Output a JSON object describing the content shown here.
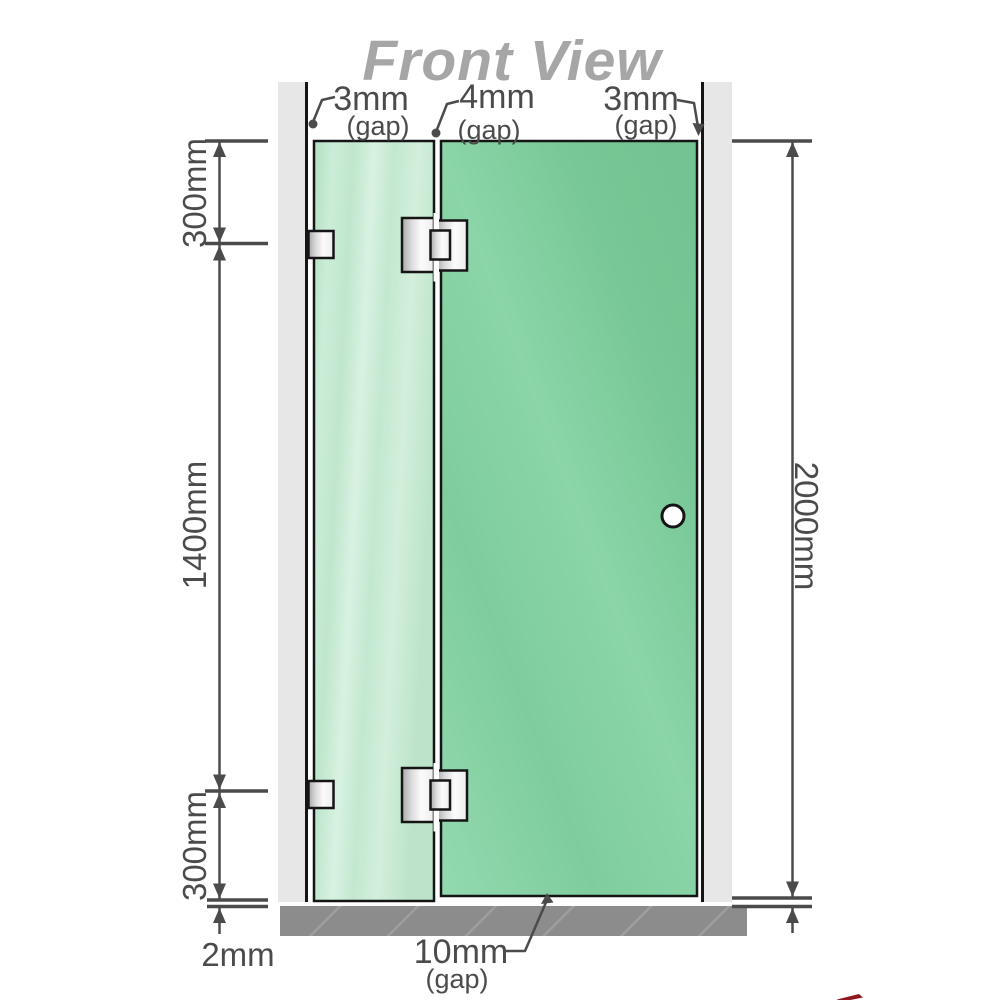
{
  "title": "Front View",
  "measurements": {
    "top_gaps": [
      {
        "value": "3mm",
        "label": "(gap)"
      },
      {
        "value": "4mm",
        "label": "(gap)"
      },
      {
        "value": "3mm",
        "label": "(gap)"
      }
    ],
    "left": {
      "top_segment": "300mm",
      "middle_segment": "1400mm",
      "bottom_segment": "300mm",
      "floor_clearance": "2mm"
    },
    "right": {
      "overall_height": "2000mm"
    },
    "bottom_gap": {
      "value": "10mm",
      "label": "(gap)"
    }
  },
  "colors": {
    "title_text": "#a6a6a6",
    "dimension": "#4b4b4b",
    "outline": "#151515",
    "wall": "#e7e7e7",
    "floor": "#8c8c8c",
    "floor_hatch": "#9e9e9e",
    "glass_fixed_panel": "#c9ecd6",
    "glass_door_panel": "#7ecc9c",
    "hinge_metal": "#e8e8e8",
    "handle_fill": "#ffffff",
    "logo_red": "#8e1722"
  }
}
